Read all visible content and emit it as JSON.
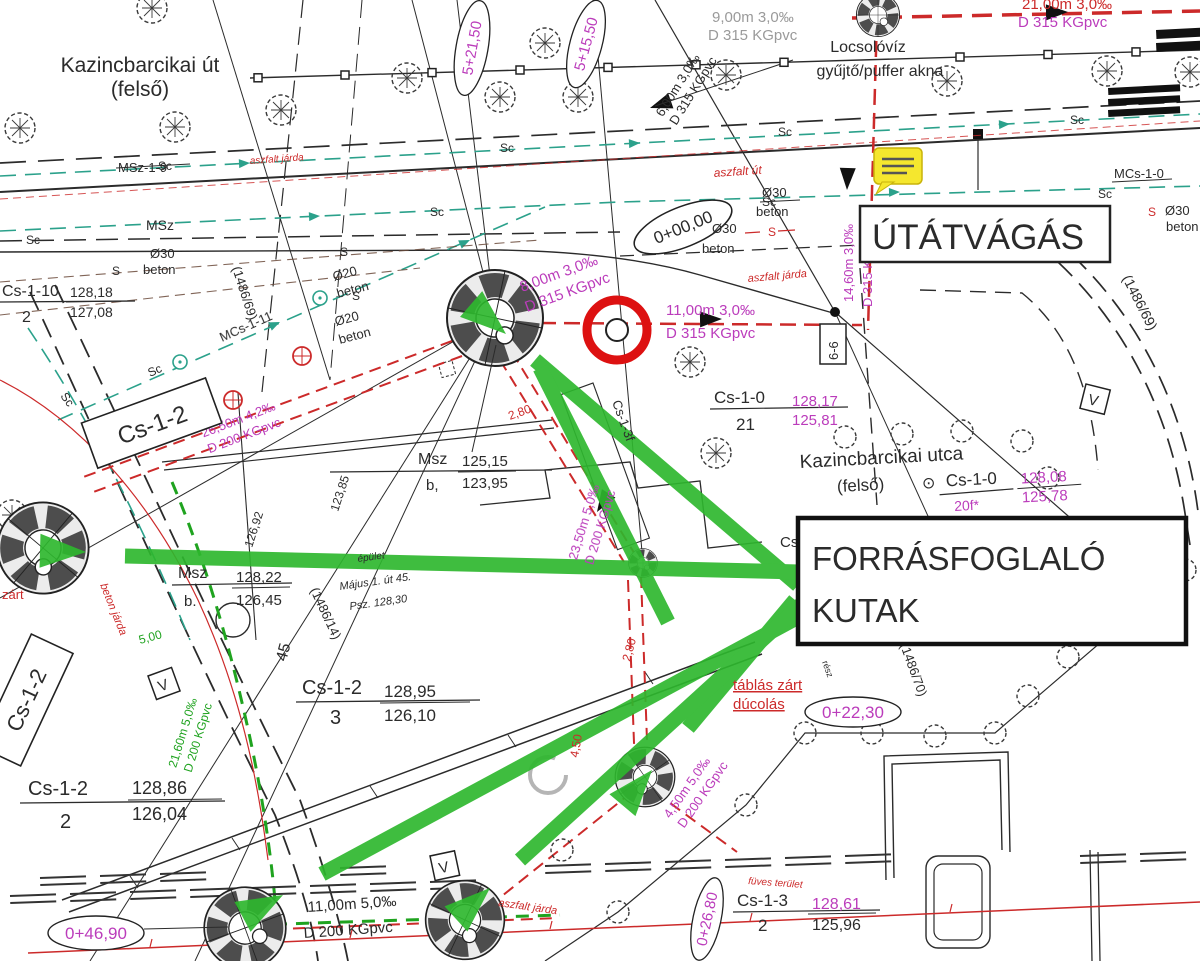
{
  "colors": {
    "paper": "#ffffff",
    "ink": "#2b2b2b",
    "red_pipe": "#cc2a2a",
    "magenta": "#bb3cbb",
    "teal_sc": "#2ba18b",
    "green_arrow": "#2eb82e",
    "green_pipe": "#1fa31f",
    "gray_ghost": "#9a9a9a",
    "yellow_note": "#f5e72e"
  },
  "streets": {
    "top": {
      "line1": "Kazincbarcikai út",
      "line2": "(felső)"
    },
    "mid": {
      "name": "Kazincbarcikai utca",
      "line2": "(felső)",
      "sep": "⊙",
      "ref": "Cs-1-0"
    }
  },
  "callouts": {
    "utatvagas": "ÚTÁTVÁGÁS",
    "forras1": "FORRÁSFOGLALÓ",
    "forras2": "KUTAK",
    "locsol1": "Locsolóvíz",
    "locsol2": "gyűjtő/puffer akna",
    "tablas1": "táblás zárt",
    "tablas2": "dúcolás",
    "zart": "zárt",
    "resz": "rész"
  },
  "pipe_labels": {
    "p2100": {
      "l1": "21,00m 3,0‰",
      "l2": "D 315 KGpvc"
    },
    "p900": {
      "l1": "9,00m 3,0‰",
      "l2": "D 315 KGpvc"
    },
    "p600": {
      "l1": "6,00m 3,0‰",
      "l2": "D 315 KGpvc"
    },
    "p1460": {
      "l1": "14,60m 3,0‰",
      "l2": "D 315 KGpvc"
    },
    "p800": {
      "l1": "8,00m 3,0‰",
      "l2": "D 315 KGpvc"
    },
    "p1100": {
      "l1": "11,00m 3,0‰",
      "l2": "D 315 KGpvc"
    },
    "p2350": {
      "l1": "23,50m 5,0‰",
      "l2": "D 200 KGpvc"
    },
    "p2650": {
      "l1": "26,50m 4,2‰",
      "l2": "D 200 KGpvc"
    },
    "p450": {
      "l1": "4,50m 5,0‰",
      "l2": "D 200 KGpvc"
    },
    "p1100b": {
      "l1": "11,00m 5,0‰",
      "l2": "D 200 KGpvc"
    },
    "p2160": {
      "l1": "21,60m 5,0‰",
      "l2": "D 200 KGpvc"
    }
  },
  "stations": {
    "s0": "0+00,00",
    "s2230": "0+22,30",
    "s2680": "0+26,80",
    "s4690": "0+46,90",
    "s52150": "5+21,50",
    "s51550": "5+15,50"
  },
  "nodes": {
    "cs110": {
      "name": "Cs-1-10",
      "num": "2",
      "top": "128,18",
      "bot": "127,08"
    },
    "cs12a": {
      "name": "Cs-1-2"
    },
    "cs12b": {
      "name": "Cs-1-2"
    },
    "cs12_2": {
      "name": "Cs-1-2",
      "num": "2",
      "top": "128,86",
      "bot": "126,04"
    },
    "cs12_3": {
      "name": "Cs-1-2",
      "num": "3",
      "top": "128,95",
      "bot": "126,10"
    },
    "cs13_2": {
      "name": "Cs-1-3",
      "num": "2",
      "top": "128,61",
      "bot": "125,96"
    },
    "cs10_21": {
      "name": "Cs-1-0",
      "num": "21",
      "top": "128,17",
      "bot": "125,81"
    },
    "cs10_20": {
      "num": "20f*",
      "top": "128,08",
      "bot": "125,78"
    },
    "msz_left": {
      "name": "Msz",
      "sub": "b.",
      "top": "128,22",
      "bot": "126,45"
    },
    "msz_mid": {
      "name": "Msz",
      "sub": "b,",
      "top": "125,15",
      "bot": "123,95"
    },
    "cs13f": "Cs-1-3f",
    "cs_part": "Cs",
    "msz19": "MSz-1-9",
    "msz": "MSz",
    "mcs10": "MCs-1-0",
    "mcs111": "MCs-1-11"
  },
  "parcels": {
    "p69": "(1486/69)",
    "p14": "(1486/14)",
    "p70": "(1486/70)"
  },
  "line_marks": {
    "sc": "Sc",
    "s": "S"
  },
  "materials": {
    "d30": "Ø30",
    "d20": "Ø20",
    "beton": "beton"
  },
  "surfaces": {
    "aszfalt_ut": "aszfalt út",
    "aszfalt_jarda": "aszfalt járda",
    "beton_jarda": "beton járda",
    "fuves": "füves terület"
  },
  "dims": {
    "d280": "2,80",
    "d450": "4,50",
    "d500": "5,00"
  },
  "elevations": {
    "e12385": "123,85",
    "e12692": "126,92",
    "hsz45": "45"
  },
  "building": {
    "l1": "épület",
    "l2": "Május 1. út 45.",
    "l3": "Psz. 128,30"
  },
  "section": {
    "s66": "6-6",
    "v": "V"
  }
}
